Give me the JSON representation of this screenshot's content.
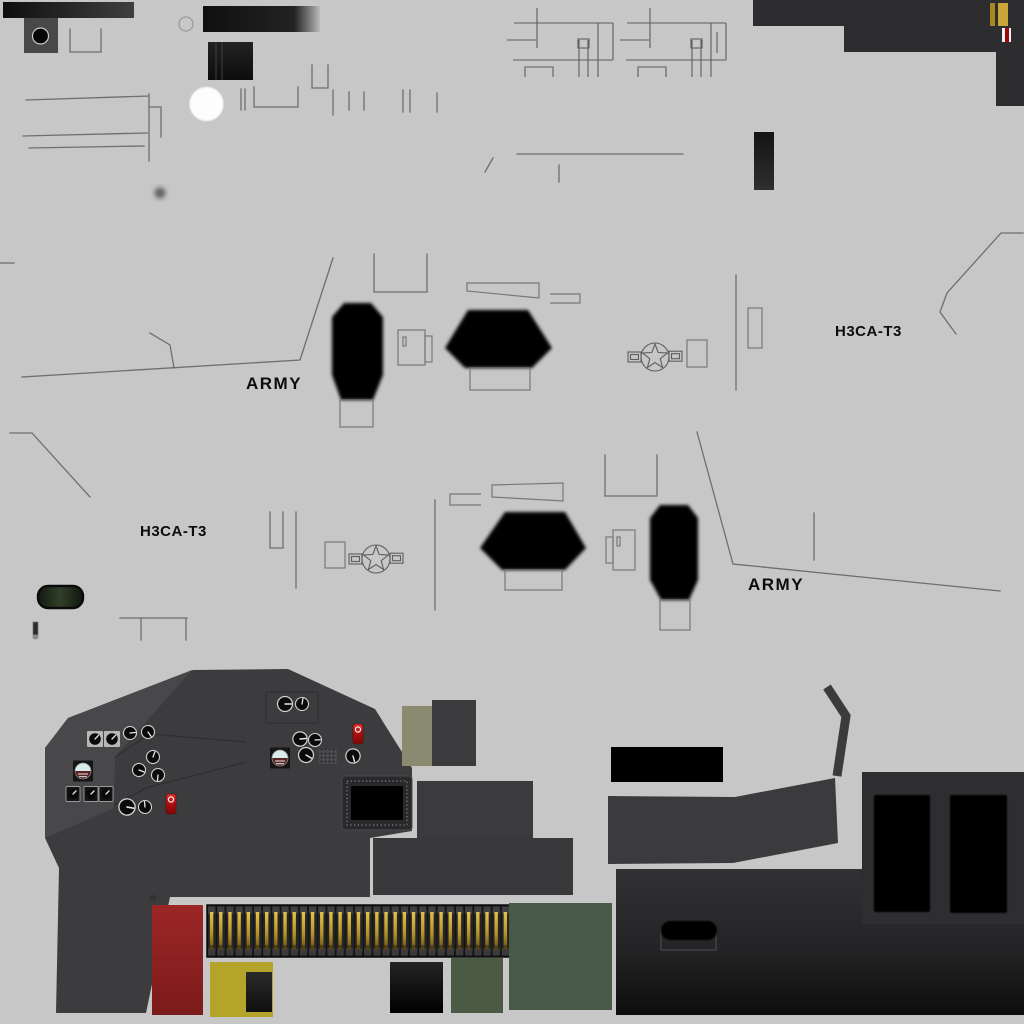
{
  "texture": {
    "title": "helicopter-texture-atlas",
    "markings": {
      "army_upper": "ARMY",
      "h3ca_upper": "H3CA-T3",
      "h3ca_lower": "H3CA-T3",
      "army_lower": "ARMY"
    }
  },
  "palette": {
    "bg": "#c6c7c6",
    "line": "#6e6e6e",
    "ink": "#0c0c0c",
    "black": "#050505",
    "dark-block": "#2d2d2f",
    "cockpit": "#3c3c3f",
    "cockpit-light": "#48484b",
    "gold": "#c9a636",
    "gold-dark": "#a8871f",
    "stripe-red": "#9e0505",
    "stripe-white": "#f2f2f2",
    "seat-red": "#8e2222",
    "belt-dark": "#1c1c1e",
    "ammo-gold": "#cfac3a",
    "yellow": "#b5a42a",
    "green-small": "#4a5a44",
    "green-big": "#485a47",
    "olive": "#8a8a71",
    "gauge-face": "#0a0a0a",
    "gauge-rim": "#d2d2d2",
    "attitude-sky": "#d8ecec",
    "attitude-ground": "#5a2323",
    "switch-red": "#cf1414",
    "pill-green": "#24341f"
  }
}
